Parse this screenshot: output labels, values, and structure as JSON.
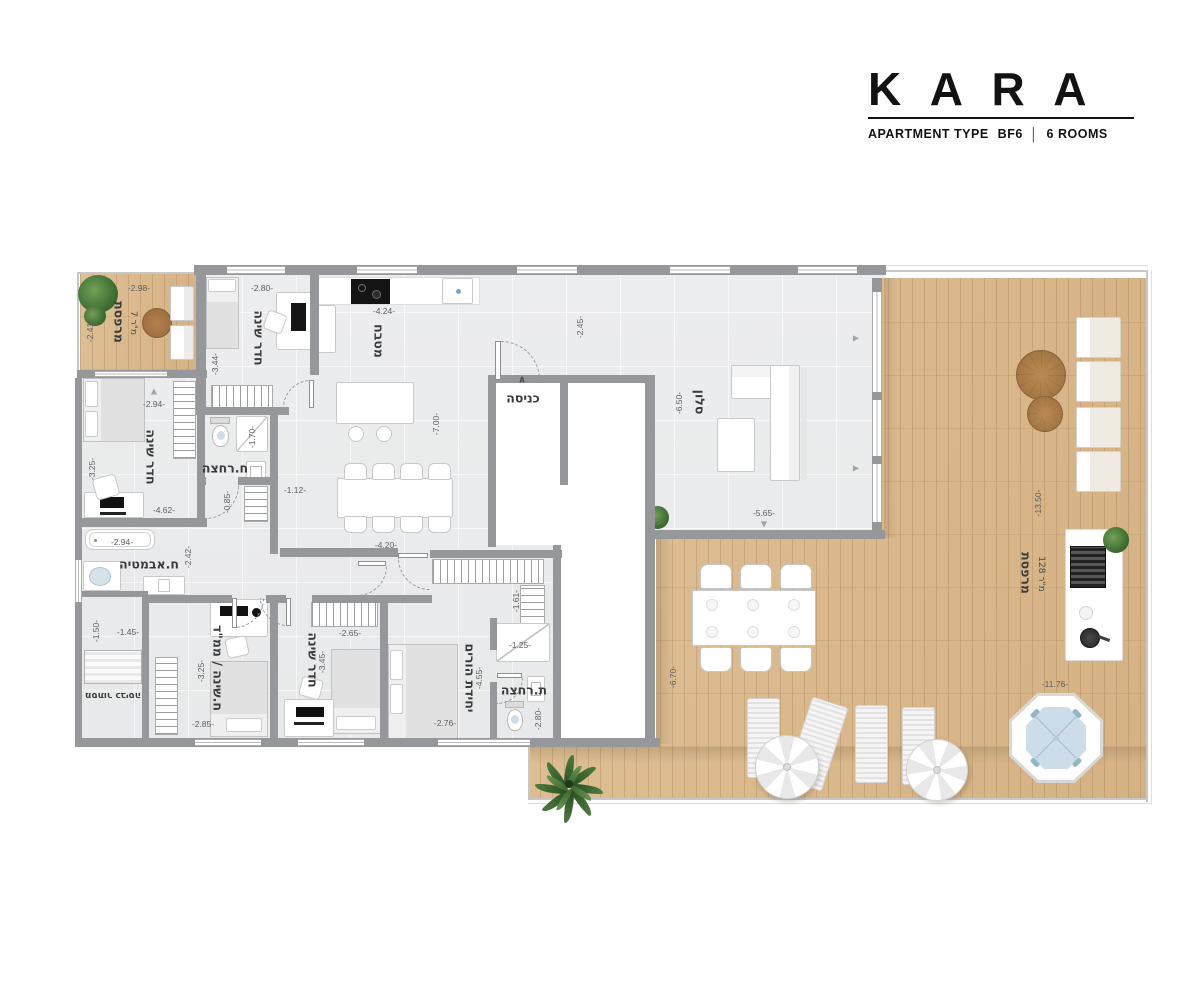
{
  "brand": {
    "name": "KARA",
    "subtitle": "APARTMENT TYPE",
    "type_code": "BF6",
    "separator": "|",
    "rooms_text": "6 ROOMS"
  },
  "colors": {
    "wall": "#96979a",
    "wood": "#d9b88c",
    "interior_floor": "#ebecee",
    "water": "#ccdce8",
    "brand_black": "#121212"
  },
  "plan": {
    "room_labels": [
      {
        "text": "מרפסת",
        "x": 119,
        "y": 322,
        "v": 1
      },
      {
        "text": "7 מ\"ר",
        "x": 133,
        "y": 323,
        "v": 1,
        "small": 1
      },
      {
        "text": "חדר שינה",
        "x": 259,
        "y": 338,
        "v": 1
      },
      {
        "text": "מטבח",
        "x": 379,
        "y": 341,
        "v": 1
      },
      {
        "text": "כניסה",
        "x": 523,
        "y": 398
      },
      {
        "text": "סלון",
        "x": 700,
        "y": 402,
        "v": 1
      },
      {
        "text": "חדר שינה",
        "x": 151,
        "y": 457,
        "v": 1
      },
      {
        "text": "ח.רחצה",
        "x": 225,
        "y": 468
      },
      {
        "text": "ח.אבמטיה",
        "x": 149,
        "y": 564
      },
      {
        "text": "מסתור כביסה",
        "x": 113,
        "y": 695,
        "flip": 1
      },
      {
        "text": "ח.שינה / ממ\"ד",
        "x": 218,
        "y": 668,
        "v": 1
      },
      {
        "text": "חדר שינה",
        "x": 313,
        "y": 660,
        "v": 1
      },
      {
        "text": "יחידת הורים",
        "x": 470,
        "y": 678,
        "v": 1
      },
      {
        "text": "ת.רחצה",
        "x": 524,
        "y": 690
      },
      {
        "text": "מרפסת",
        "x": 1026,
        "y": 573,
        "v": 1
      },
      {
        "text": "128 מ\"ר",
        "x": 1041,
        "y": 574,
        "v": 1,
        "small": 1
      }
    ],
    "dimensions": [
      {
        "t": "-2.98-",
        "x": 139,
        "y": 288
      },
      {
        "t": "-2.80-",
        "x": 262,
        "y": 288
      },
      {
        "t": "-4.24-",
        "x": 384,
        "y": 311
      },
      {
        "t": "-2.45-",
        "x": 580,
        "y": 327,
        "v": 1
      },
      {
        "t": "-2.41-",
        "x": 90,
        "y": 331,
        "v": 1
      },
      {
        "t": "-3.44-",
        "x": 215,
        "y": 364,
        "v": 1
      },
      {
        "t": "-2.94-",
        "x": 154,
        "y": 404
      },
      {
        "t": "-1.70-",
        "x": 252,
        "y": 437,
        "v": 1
      },
      {
        "t": "-3.25-",
        "x": 92,
        "y": 469,
        "v": 1
      },
      {
        "t": "-7.00-",
        "x": 436,
        "y": 424,
        "v": 1
      },
      {
        "t": "-6.50-",
        "x": 679,
        "y": 403,
        "v": 1
      },
      {
        "t": "-1.12-",
        "x": 295,
        "y": 490
      },
      {
        "t": "-0.85-",
        "x": 227,
        "y": 502,
        "v": 1
      },
      {
        "t": "-4.62-",
        "x": 164,
        "y": 510
      },
      {
        "t": "-2.94-",
        "x": 122,
        "y": 542
      },
      {
        "t": "-5.65-",
        "x": 764,
        "y": 513
      },
      {
        "t": "-4.20-",
        "x": 386,
        "y": 545
      },
      {
        "t": "-2.42-",
        "x": 188,
        "y": 557,
        "v": 1
      },
      {
        "t": "-1.61-",
        "x": 516,
        "y": 601,
        "v": 1
      },
      {
        "t": "-1.50-",
        "x": 96,
        "y": 631,
        "v": 1
      },
      {
        "t": "-1.45-",
        "x": 128,
        "y": 632
      },
      {
        "t": "-2.65-",
        "x": 350,
        "y": 633
      },
      {
        "t": "-1.25-",
        "x": 520,
        "y": 645
      },
      {
        "t": "-3.25-",
        "x": 201,
        "y": 671,
        "v": 1
      },
      {
        "t": "-3.45-",
        "x": 322,
        "y": 662,
        "v": 1
      },
      {
        "t": "-6.70-",
        "x": 673,
        "y": 677,
        "v": 1
      },
      {
        "t": "-4.55-",
        "x": 479,
        "y": 678,
        "v": 1
      },
      {
        "t": "-2.76-",
        "x": 445,
        "y": 723
      },
      {
        "t": "-2.80-",
        "x": 538,
        "y": 719,
        "v": 1
      },
      {
        "t": "-2.85-",
        "x": 203,
        "y": 724
      },
      {
        "t": "-13.50-",
        "x": 1038,
        "y": 503,
        "v": 1
      },
      {
        "t": "-11.76-",
        "x": 1055,
        "y": 684
      }
    ],
    "markers": [
      {
        "glyph": "∧",
        "x": 522,
        "y": 380,
        "caret": 1
      },
      {
        "glyph": "▲",
        "x": 154,
        "y": 391
      },
      {
        "glyph": "▼",
        "x": 764,
        "y": 524
      },
      {
        "glyph": "▶",
        "x": 856,
        "y": 338
      },
      {
        "glyph": "▶",
        "x": 856,
        "y": 468
      }
    ]
  }
}
